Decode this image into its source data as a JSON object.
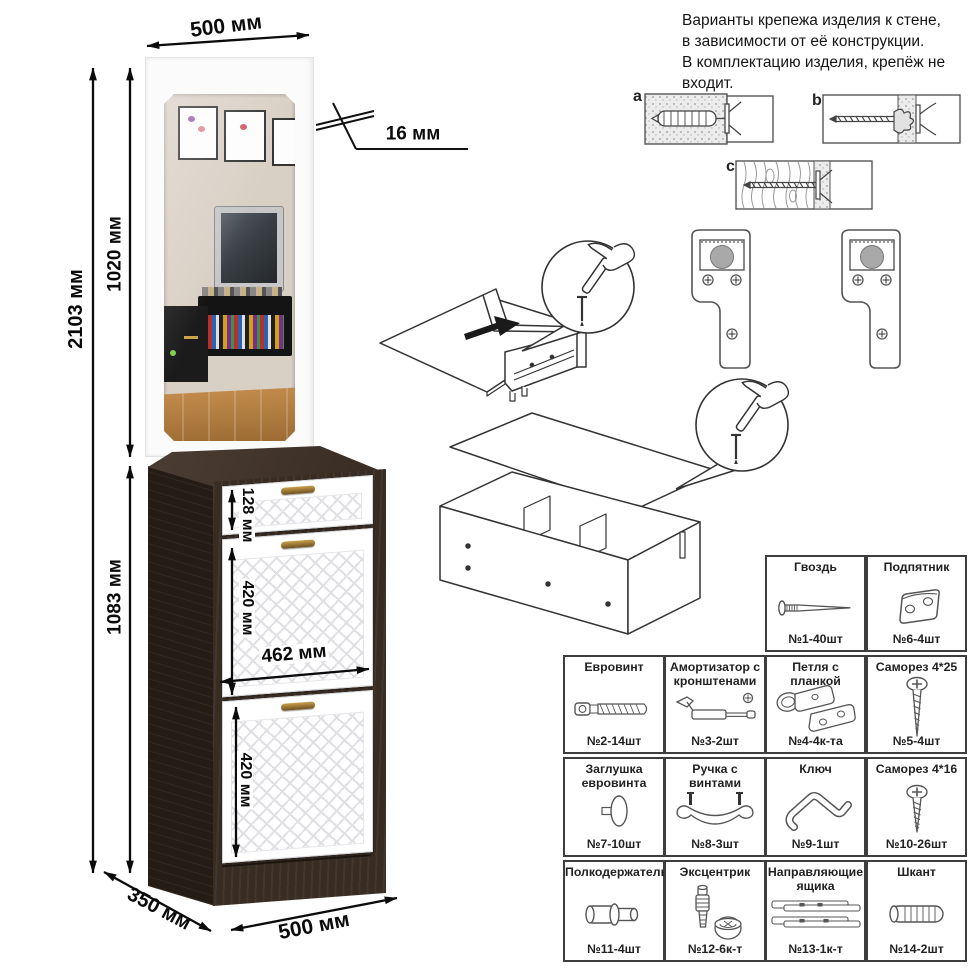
{
  "dims": {
    "top_width": "500 мм",
    "thickness": "16 мм",
    "total_height": "2103 мм",
    "mirror_height": "1020 мм",
    "cabinet_height": "1083 мм",
    "drawer_height": "128 мм",
    "door_upper_height": "420 мм",
    "front_width": "462 мм",
    "door_lower_height": "420 мм",
    "depth": "350 мм",
    "bottom_width": "500 мм"
  },
  "note_lines": [
    "Варианты крепежа изделия к стене,",
    "в зависимости от её конструкции.",
    "В комплектацию изделия, крепёж не",
    "входит."
  ],
  "mounts": [
    "a",
    "b",
    "c"
  ],
  "parts": {
    "row1": [
      {
        "name": "Гвоздь",
        "qty": "№1-40шт"
      },
      {
        "name": "Подпятник",
        "qty": "№6-4шт"
      }
    ],
    "row2": [
      {
        "name": "Евровинт",
        "qty": "№2-14шт"
      },
      {
        "name": "Амортизатор с кронштенами",
        "qty": "№3-2шт"
      },
      {
        "name": "Петля с планкой",
        "qty": "№4-4к-та"
      },
      {
        "name": "Саморез 4*25",
        "qty": "№5-4шт"
      }
    ],
    "row3": [
      {
        "name": "Заглушка евровинта",
        "qty": "№7-10шт"
      },
      {
        "name": "Ручка с винтами",
        "qty": "№8-3шт"
      },
      {
        "name": "Ключ",
        "qty": "№9-1шт"
      },
      {
        "name": "Саморез 4*16",
        "qty": "№10-26шт"
      }
    ],
    "row4": [
      {
        "name": "Полкодержатель",
        "qty": "№11-4шт"
      },
      {
        "name": "Эксцентрик",
        "qty": "№12-6к-т"
      },
      {
        "name": "Направляющие ящика",
        "qty": "№13-1к-т"
      },
      {
        "name": "Шкант",
        "qty": "№14-2шт"
      }
    ]
  },
  "colors": {
    "cabinet_wenge": "#382c23",
    "front_white": "#ffffff",
    "handle_bronze": "#8a6a35",
    "dimension_black": "#0b0b0b"
  }
}
